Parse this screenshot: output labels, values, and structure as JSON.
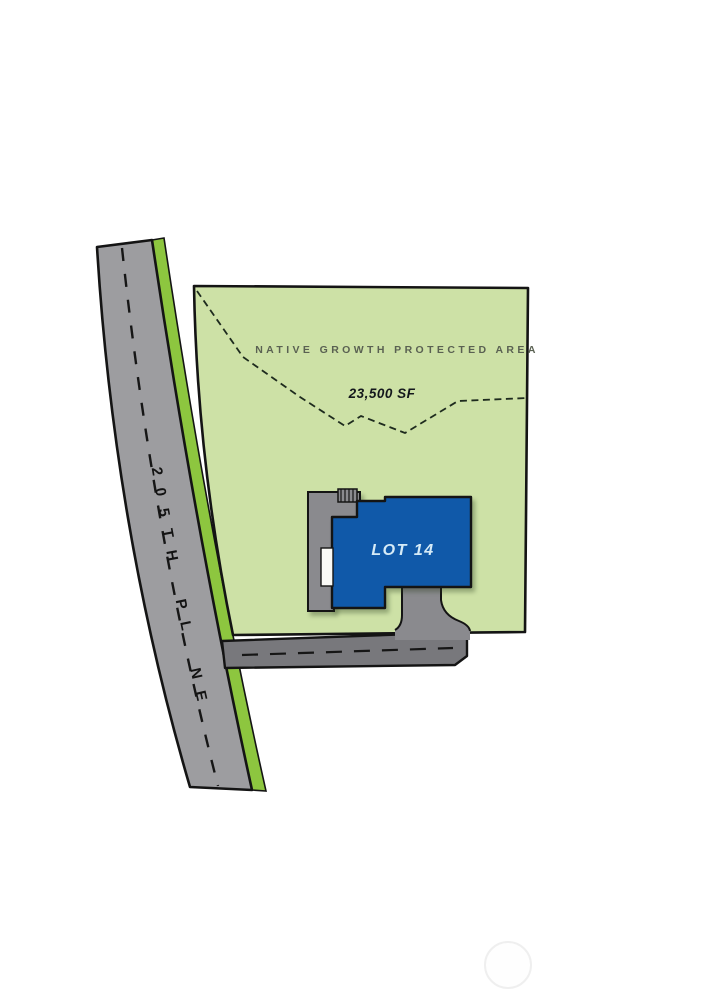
{
  "site_plan": {
    "street_label": "205TH PL NE",
    "protected_area_label": "NATIVE GROWTH PROTECTED AREA",
    "protected_area_size": "23,500 SF",
    "lot_label": "LOT 14",
    "colors": {
      "lot_green": "#cde1a6",
      "planting_strip_green": "#8dc63f",
      "main_road_gray": "#9d9da0",
      "private_drive_gray": "#78787c",
      "driveway_gray": "#8a8a8e",
      "deck_gray": "#8a8a8e",
      "house_blue": "#1059a9",
      "outline_black": "#141414",
      "protected_area_text_color": "#5a6152",
      "lot_label_color": "#d6ebf7"
    }
  }
}
